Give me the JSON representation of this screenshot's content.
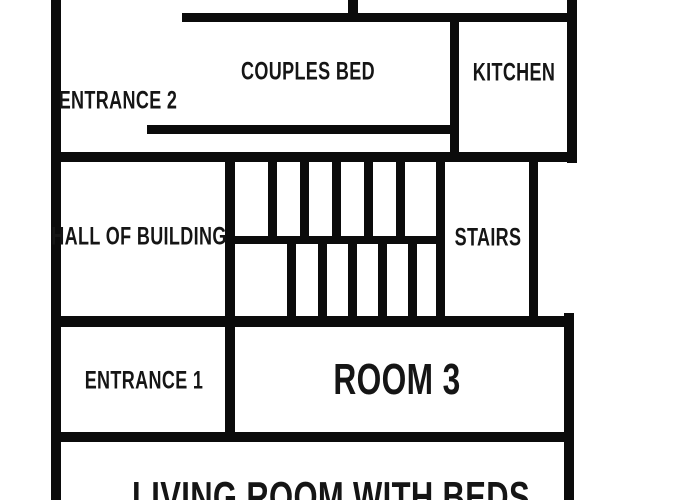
{
  "diagram": {
    "type": "floor-plan",
    "colors": {
      "wall": "#0b0b0b",
      "background": "#ffffff",
      "label_text": "#151515"
    },
    "rooms": {
      "entrance2": {
        "label": "ENTRANCE 2"
      },
      "couples_bed": {
        "label": "COUPLES BED"
      },
      "kitchen": {
        "label": "KITCHEN"
      },
      "hall": {
        "label": "HALL OF BUILDING"
      },
      "stairs": {
        "label": "STAIRS"
      },
      "entrance1": {
        "label": "ENTRANCE 1"
      },
      "room3": {
        "label": "ROOM 3"
      },
      "living_room": {
        "label": "LIVING ROOM WITH BEDS"
      }
    }
  }
}
